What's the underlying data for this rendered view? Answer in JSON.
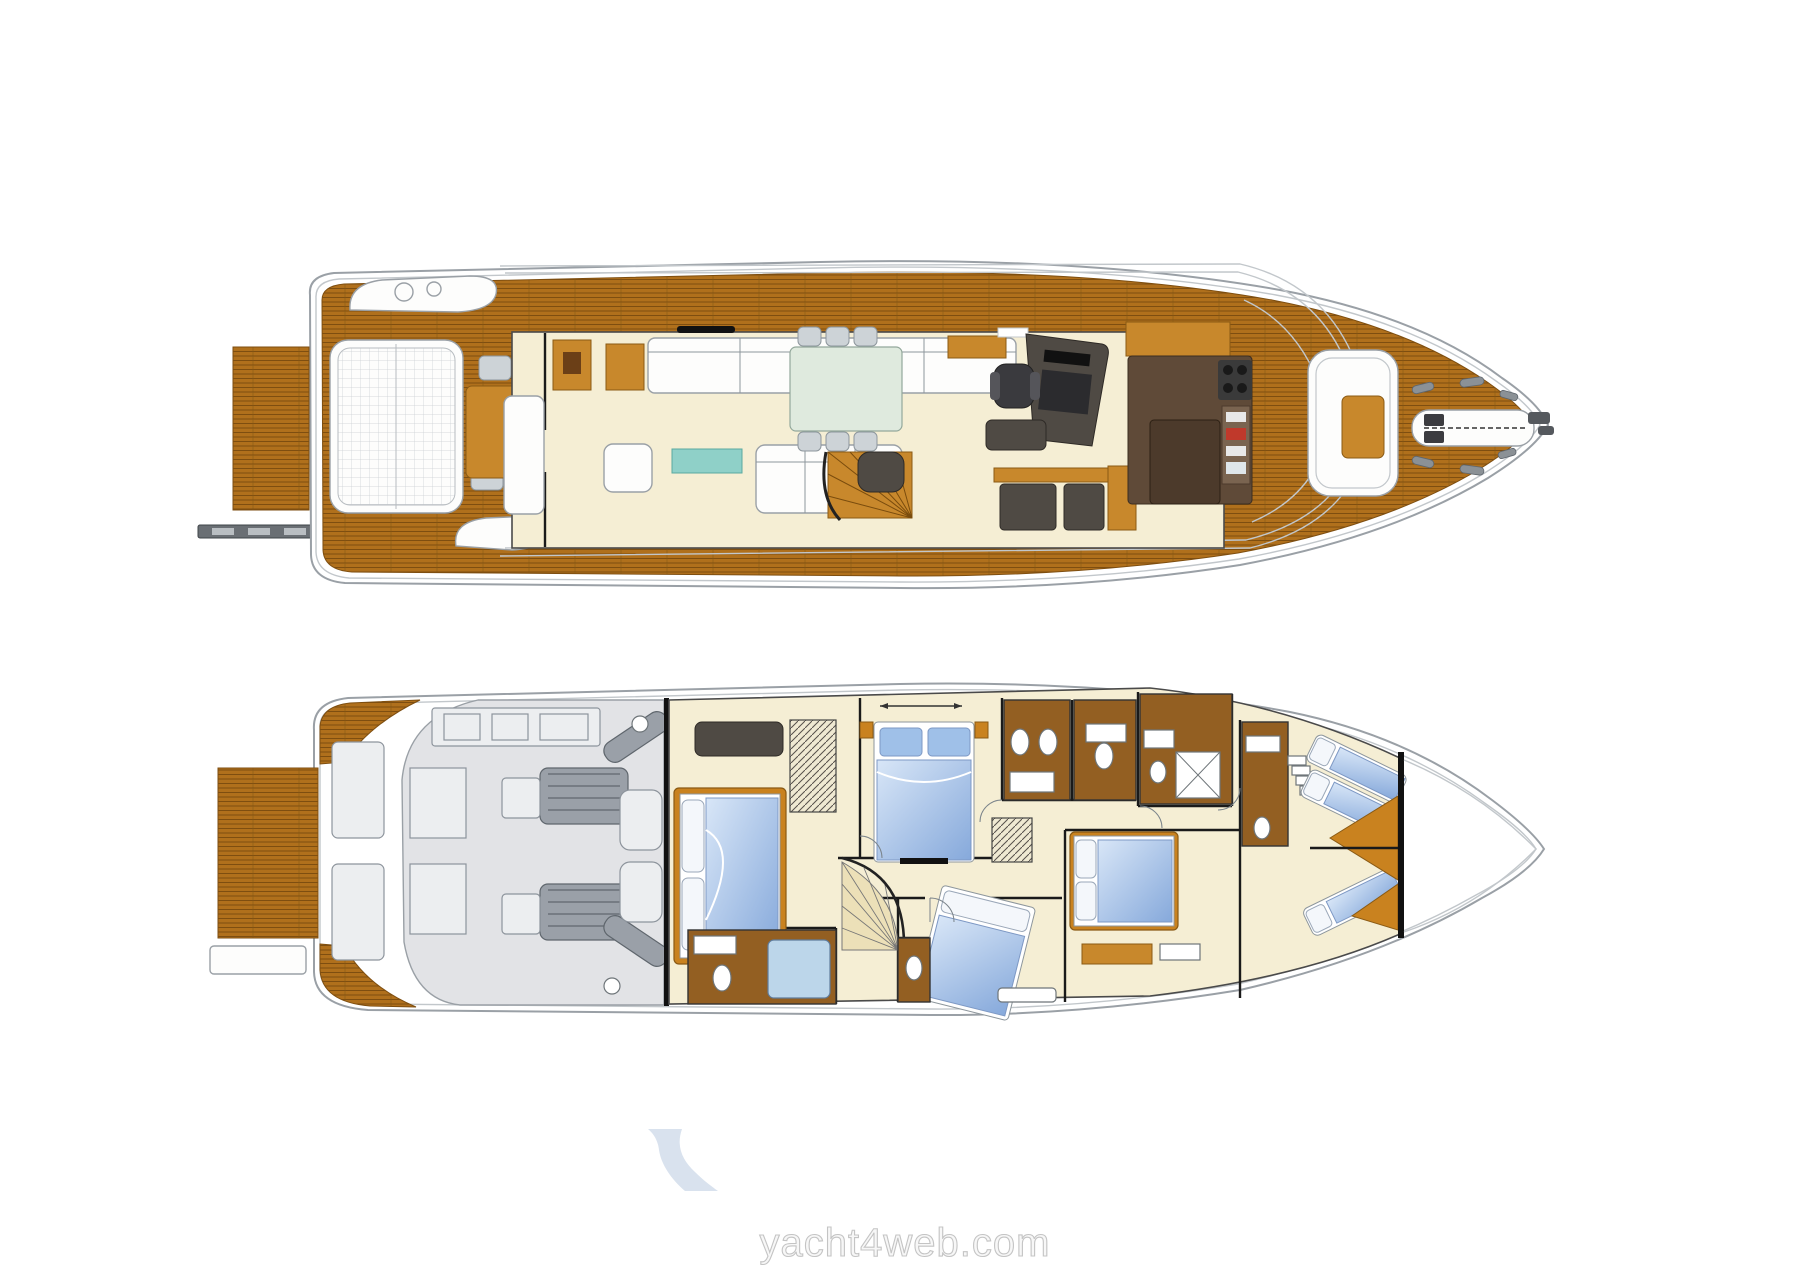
{
  "watermark": {
    "text": "yacht4web.com"
  },
  "logo": {
    "icon": "yacht4web-swoosh"
  },
  "palette": {
    "hull_line": "#9aa0a6",
    "gunwale_line": "#c2c7cb",
    "teak": "#b0701c",
    "teak_line": "#7e4e10",
    "wood": "#c8882c",
    "wood_dark": "#8a5a14",
    "cream": "#f5eed4",
    "cabinet": "#c9821f",
    "galley": "#5f4a38",
    "bath_floor": "#935f22",
    "dark_furniture": "#4f4a44",
    "chair_gray": "#cdd3d7",
    "engine_floor": "#e2e3e6",
    "engine_metal": "#9aa0a8",
    "bed_blue": "#86a9db",
    "bed_blue_light": "#d8e6f7",
    "pillow_blue": "#9fc0e8",
    "shower_blue": "#bcd6ea",
    "teal": "#8fd0c8",
    "dining_table": "#dfeade",
    "cleat_gray": "#8b9196",
    "black": "#1a1a1a",
    "watermark_fill": "#f7f7f7",
    "watermark_stroke": "#c4c4c4",
    "logo_blue": "#d9e2ee"
  }
}
